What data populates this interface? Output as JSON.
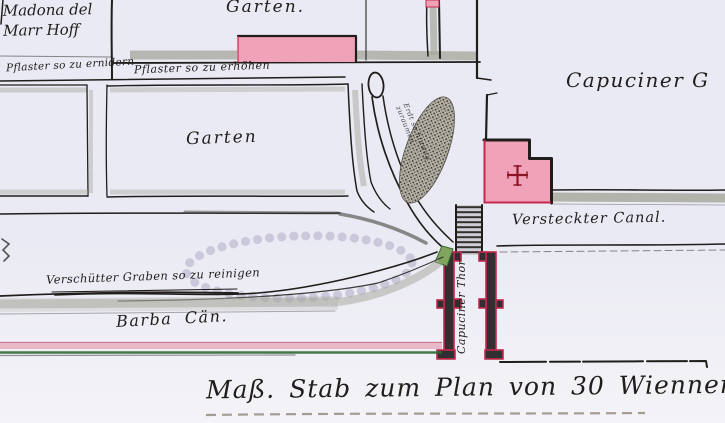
{
  "colors": {
    "paper": "#eaeaf4",
    "paper_bottom": "#f4f3f7",
    "ink": "#201d1b",
    "street_gray": "#a4a699",
    "building_pink": "#f0a3b8",
    "building_outline": "#c22a4e",
    "cross_red": "#8e1425",
    "stipple_lavender": "#c8c4d9",
    "green_dark": "#2f6b33",
    "green_patch": "#82a55e",
    "pink_strip": "#e9b9ca",
    "scale_dash": "#958d80",
    "gate_fill": "#332e31"
  },
  "labels": {
    "district_block": {
      "line1": "Madona del",
      "line2": "Marr Hoff"
    },
    "annotation_pavement_left": "Pflaster so zu ernidern",
    "annotation_pavement_right": "Pflaster so zu erhöhen",
    "garden_top": "Garten.",
    "garden_middle": "Garten",
    "capuciner_garden": "Capuciner G",
    "excavation_note_line1": "Erdt so hinweg",
    "excavation_note_line2": "zuraumen",
    "canal_right": "Versteckter Canal.",
    "ditch_note": "Verschütter Graben so zu reinigen",
    "canal_left": "Barba Cän.",
    "gate": "Capuciner Thor",
    "scale_caption": "Maß. Stab zum Plan von 30 Wienner Clafter"
  }
}
